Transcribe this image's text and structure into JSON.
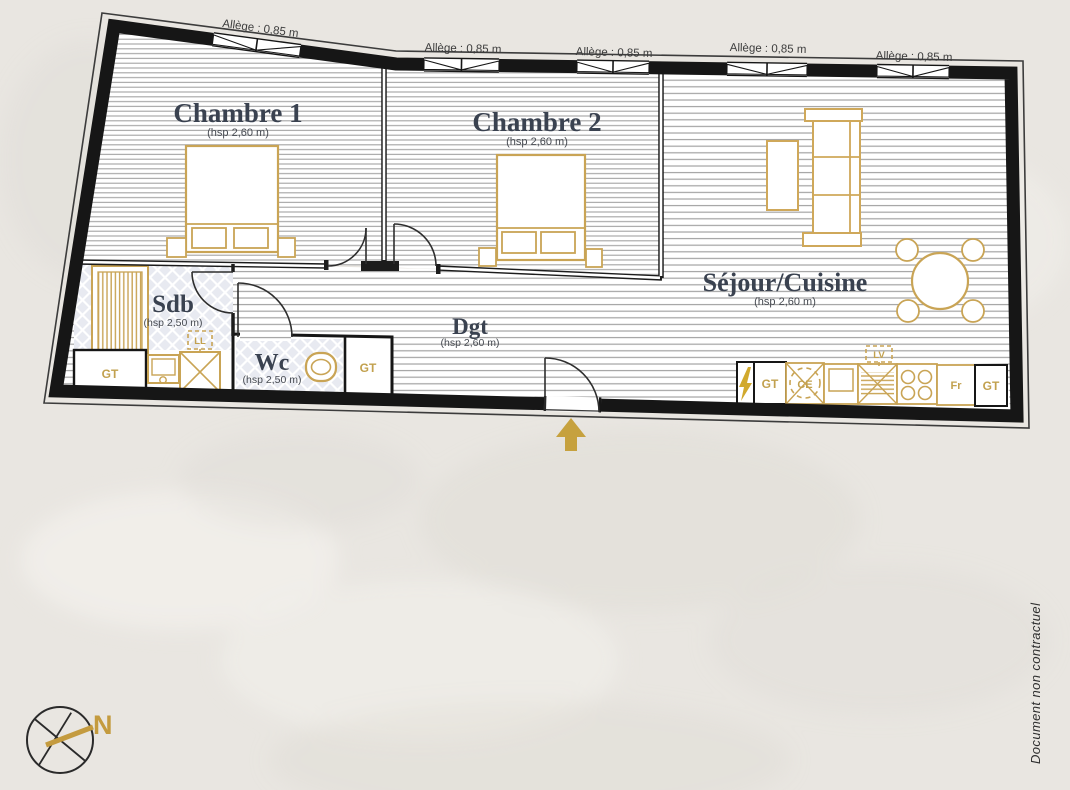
{
  "footer": {
    "note": "Document non contractuel"
  },
  "compass": {
    "north": "N"
  },
  "windows": [
    {
      "label": "Allège : 0,85 m"
    },
    {
      "label": "Allège : 0,85 m"
    },
    {
      "label": "Allège : 0,85 m"
    },
    {
      "label": "Allège : 0,85 m"
    },
    {
      "label": "Allège : 0,85 m"
    }
  ],
  "rooms": [
    {
      "name": "Chambre 1",
      "ceiling": "(hsp 2,60 m)"
    },
    {
      "name": "Chambre 2",
      "ceiling": "(hsp 2,60 m)"
    },
    {
      "name": "Séjour/Cuisine",
      "ceiling": "(hsp 2,60 m)"
    },
    {
      "name": "Sdb",
      "ceiling": "(hsp 2,50 m)"
    },
    {
      "name": "Wc",
      "ceiling": "(hsp 2,50 m)"
    },
    {
      "name": "Dgt",
      "ceiling": "(hsp 2,60 m)"
    }
  ],
  "fixtures": {
    "gt": "GT",
    "ll": "LL",
    "lv": "LV",
    "ce": "CE",
    "fr": "Fr"
  },
  "colors": {
    "background": "#e9e6e1",
    "wall": "#161616",
    "furniture_gold": "#c9a455",
    "label_gold": "#c2a14f",
    "room_title": "#3a4250",
    "tile_fill": "#e8eaf1",
    "hatch_line": "#a3a3a3"
  }
}
